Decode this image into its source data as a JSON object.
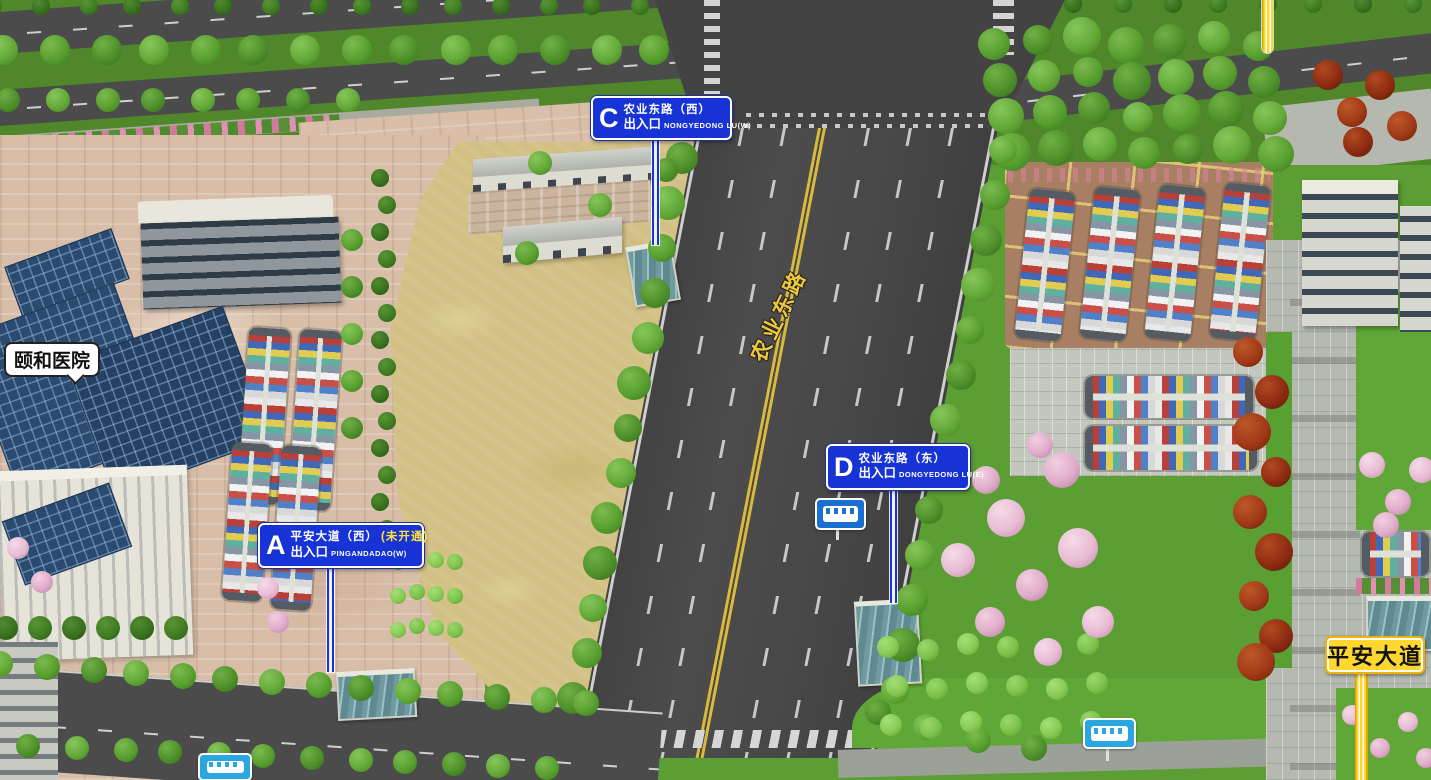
{
  "map": {
    "hospital_label": "颐和医院",
    "vertical_road_label": "农业东路",
    "bottom_road_label": "平安大道",
    "entrances": {
      "a": {
        "letter": "A",
        "road_name": "平安大道（西）",
        "status_note": "(未开通)",
        "entrance_text": "出入口",
        "road_roman": "PINGANDADAO(W)"
      },
      "c": {
        "letter": "C",
        "road_name": "农业东路（西）",
        "entrance_text": "出入口",
        "road_roman": "NONGYEDONG LU(W)"
      },
      "d": {
        "letter": "D",
        "road_name": "农业东路（东）",
        "entrance_text": "出入口",
        "road_roman": "DONGYEDONG LU(E)"
      }
    },
    "icons": {
      "bus_stop": "bus-icon"
    },
    "colors": {
      "sign_blue": "#1733d6",
      "status_note_yellow": "#ffe339",
      "yellow_sign": "#ffd72e",
      "road_asphalt": "#474747",
      "center_line_yellow": "#d9ba3c",
      "bus_blue": "#1b6fd0",
      "bus_cyan": "#2aa7e0",
      "glass_roof_blue": "#2b4a70"
    }
  }
}
